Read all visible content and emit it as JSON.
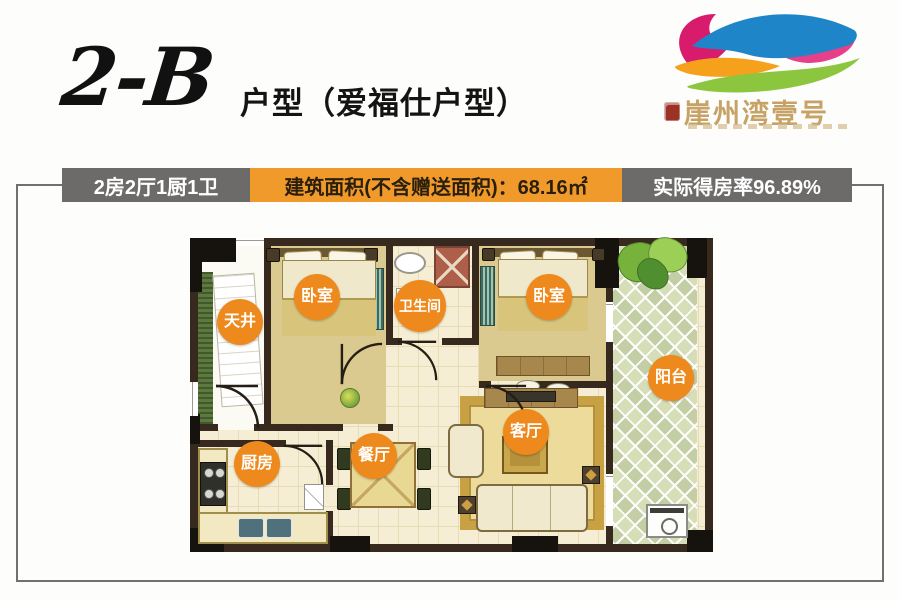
{
  "title": {
    "code": "2-B",
    "suffix": "户型（爱福仕户型）"
  },
  "logo": {
    "name": "崖州湾壹号"
  },
  "banner": {
    "rooms": "2房2厅1厨1卫",
    "area": "建筑面积(不含赠送面积)：68.16㎡",
    "area_value": "68.16㎡",
    "rate": "实际得房率96.89%",
    "rate_value": "96.89%"
  },
  "floorplan": {
    "rooms": [
      {
        "id": "light-well",
        "label": "天井"
      },
      {
        "id": "bedroom-left",
        "label": "卧室"
      },
      {
        "id": "bathroom",
        "label": "卫生间"
      },
      {
        "id": "bedroom-right",
        "label": "卧室"
      },
      {
        "id": "balcony",
        "label": "阳台"
      },
      {
        "id": "living-room",
        "label": "客厅"
      },
      {
        "id": "dining-room",
        "label": "餐厅"
      },
      {
        "id": "kitchen",
        "label": "厨房"
      }
    ]
  },
  "colors": {
    "accent_orange": "#ee8a1d",
    "banner_gray": "#6c6b69",
    "banner_orange": "#f09a2c",
    "wall_dark": "#38291f",
    "floor_cream": "#f6eed4",
    "bedroom_floor": "#dbca90",
    "balcony_green": "#cfd9ae",
    "logo_gold": "#c7a266"
  }
}
